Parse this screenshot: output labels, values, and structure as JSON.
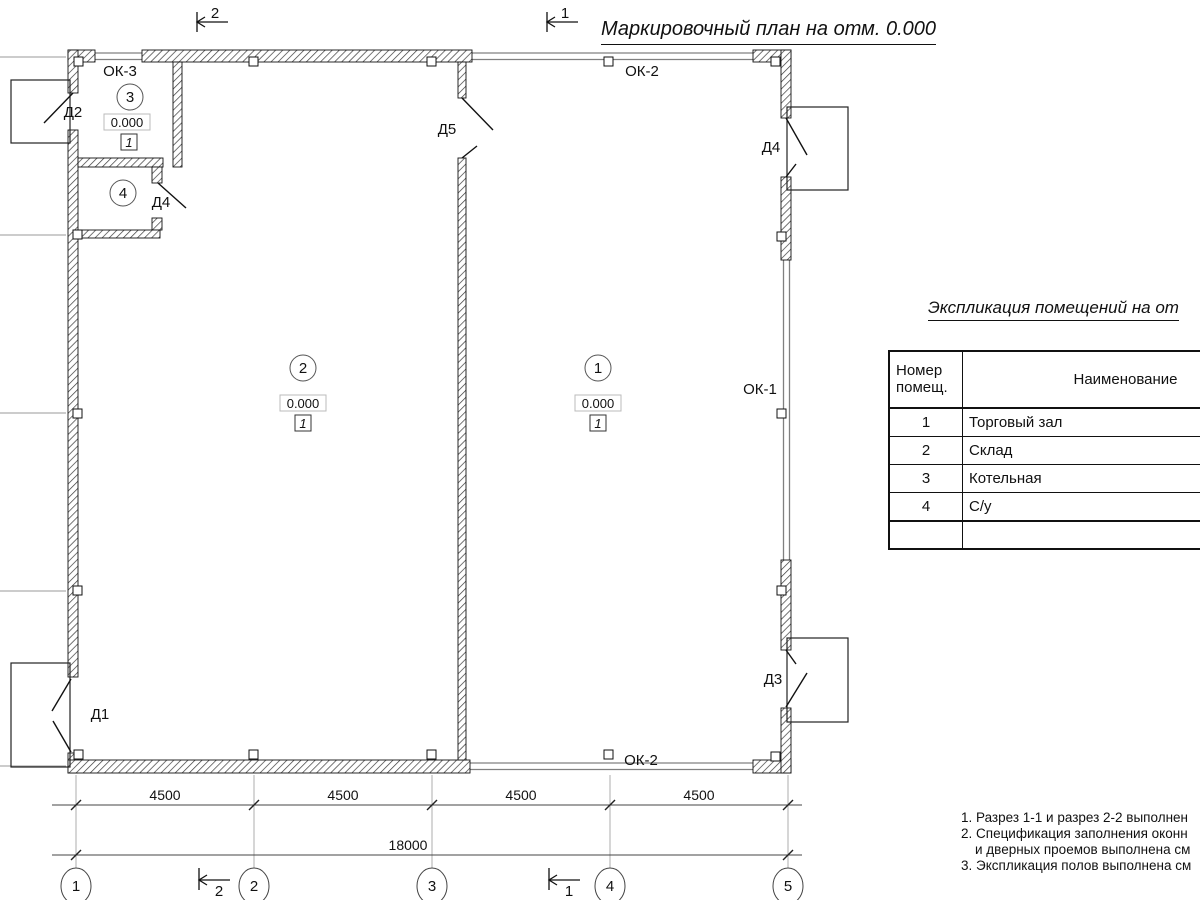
{
  "page_title": "Маркировочный план на отм. 0.000",
  "plan": {
    "rooms": {
      "r1": {
        "num": "1",
        "elevation": "0.000",
        "floor": "1"
      },
      "r2": {
        "num": "2",
        "elevation": "0.000",
        "floor": "1"
      },
      "r3": {
        "num": "3",
        "elevation": "0.000",
        "floor": "1"
      },
      "r4": {
        "num": "4"
      }
    },
    "doors": {
      "d1": "Д1",
      "d2": "Д2",
      "d3": "Д3",
      "d4": "Д4",
      "d5": "Д5"
    },
    "windows": {
      "ok1": "ОК-1",
      "ok2": "ОК-2",
      "ok3": "ОК-3"
    },
    "section_marks": {
      "s1": "1",
      "s2": "2"
    },
    "grid_axes": [
      "1",
      "2",
      "3",
      "4",
      "5"
    ],
    "dimensions": {
      "segments": [
        "4500",
        "4500",
        "4500",
        "4500"
      ],
      "total": "18000"
    }
  },
  "explication": {
    "title": "Экспликация помещений на от",
    "header": {
      "col1_line1": "Номер",
      "col1_line2": "помещ.",
      "col2": "Наименование"
    },
    "rows": [
      {
        "num": "1",
        "name": "Торговый зал"
      },
      {
        "num": "2",
        "name": "Склад"
      },
      {
        "num": "3",
        "name": "Котельная"
      },
      {
        "num": "4",
        "name": "С/у"
      }
    ]
  },
  "notes": {
    "line1": "1. Разрез 1-1 и разрез 2-2 выполнен",
    "line2": "2. Спецификация заполнения оконн",
    "line3": "и дверных проемов выполнена см",
    "line4": "3. Экспликация полов выполнена см"
  },
  "colors": {
    "ink": "#111111",
    "grid_line": "#999999",
    "window_line": "#808080",
    "dim_line": "#444444"
  }
}
